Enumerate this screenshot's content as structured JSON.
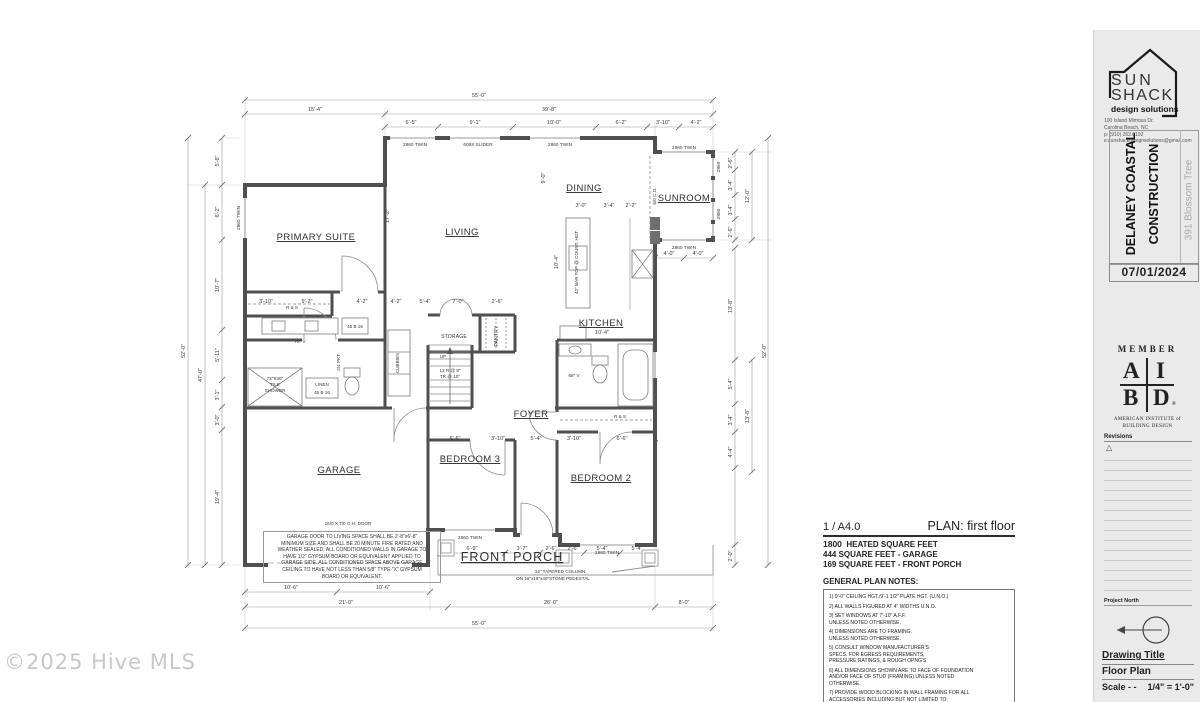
{
  "watermark": "©2025 Hive MLS",
  "rooms": {
    "primary": "PRIMARY SUITE",
    "living": "LIVING",
    "dining": "DINING",
    "sunroom": "SUNROOM",
    "kitchen": "KITCHEN",
    "foyer": "FOYER",
    "garage": "GARAGE",
    "bedroom3": "BEDROOM 3",
    "bedroom2": "BEDROOM 2",
    "porch": "FRONT PORCH",
    "storage": "STORAGE",
    "pantry": "PANTRY"
  },
  "windows": {
    "twin": "2860 TWIN",
    "slider": "6068 SLIDER",
    "single": "2860"
  },
  "fixtures": {
    "rs": "R & S",
    "b4516": "45 B 16",
    "linen": "LINEN",
    "cubbies": "CUBBIES",
    "vanity72": "72\" V",
    "vanity68": "68\" V",
    "shower1": "72\"X36\"",
    "shower2": "TILE",
    "shower3": "SHOWER",
    "pkt": "2/4 PKT.",
    "co": "6/0 C.O.",
    "bartop": "42\" BAR TOP @ COUNT. HGT.",
    "up": "UP",
    "stairs1": "13 R @ 8\"",
    "stairs2": "TR @ 10\""
  },
  "plan_notes": {
    "oh_door": "16/0 X 7/0 O.H. DOOR",
    "garage_note": "GARAGE DOOR TO LIVING SPACE SHALL BE 2'-8\"x6'-8\"\nMINIMUM SIZE AND SHALL BE 20 MINUTE FIRE RATED AND\nWEATHER SEALED. ALL CONDITIONED WALLS IN GARAGE TO\nHAVE 1/2\" GYPSUM BOARD OR EQUIVALENT APPLIED TO\nGARAGE SIDE. ALL CONDITIONED SPACE ABOVE GARAGE\nCEILING TO HAVE NOT LESS THAN 5/8\" TYPE \"X\" GYPSUM\nBOARD OR EQUIVALENT.",
    "column1": "14\" TAPERED COLUMN",
    "column2": "ON 16\"x16\"x40\"STONE PEDESTAL"
  },
  "dims": {
    "top1": [
      "55'-0\""
    ],
    "top2": [
      "15'-4\"",
      "39'-8\""
    ],
    "top3": [
      "6'-5\"",
      "9'-1\"",
      "10'-0\"",
      "6'-2\"",
      "3'-10\"",
      "4'-2\""
    ],
    "left": [
      "5'-6\"",
      "6'-2\"",
      "10'-7\"",
      "5'-11\"",
      "3'-1\"",
      "3'-0\"",
      "19'-4\"",
      "47'-0\"",
      "52'-0\""
    ],
    "right": [
      "2'-6\"",
      "3'-4\"",
      "3'-4\"",
      "2'-6\"",
      "12'-0\"",
      "13'-8\"",
      "5'-4\"",
      "3'-4\"",
      "4'-4\"",
      "2'-0\"",
      "13'-8\"",
      "52'-0\""
    ],
    "bottom": [
      "6'-9\"",
      "3'-7\"",
      "2'-6\"",
      "2'-6\"",
      "5'-4\"",
      "5'-4\"",
      "10'-6\"",
      "10'-6\"",
      "21'-0\"",
      "26'-0\"",
      "8'-0\"",
      "55'-0\""
    ],
    "interior": [
      "17'-2\"",
      "9'-0\"",
      "10'-4\"",
      "3'-0\"",
      "3'-4\"",
      "2'-2\"",
      "10'-4\"",
      "3'-10\"",
      "9'-2\"",
      "4'-2\"",
      "4'-2\"",
      "5'-4\"",
      "7'-0\"",
      "2'-6\"",
      "6'-6\"",
      "3'-10\"",
      "5'-4\"",
      "3'-10\"",
      "6'-6\"",
      "4'-0\"",
      "4'-0\""
    ]
  },
  "plan_info": {
    "sheet_ref": "1 / A4.0",
    "plan_label": "PLAN: first floor",
    "sqft_value": "1800",
    "sqft_label": "HEATED SQUARE FEET",
    "garage_sqft": "444 SQUARE FEET - GARAGE",
    "porch_sqft": "169 SQUARE FEET - FRONT PORCH",
    "notes_title": "GENERAL PLAN NOTES:",
    "notes": [
      "1) 9'-0\" CEILING HGT./9'-1 1/2\" PLATE HGT. (U.N.O.)",
      "2) ALL WALLS FIGURED AT 4\" WIDTHS U.N.O.",
      "3) SET WINDOWS AT 7'-10\" A.F.F.\n    UNLESS NOTED OTHERWISE.",
      "4) DIMENSIONS ARE TO FRAMING.\n    UNLESS NOTED OTHERWISE.",
      "5) CONSULT WINDOW MANUFACTURER'S\n    SPECS. FOR EGRESS REQUIREMENTS,\n    PRESSURE RATINGS, & ROUGH OPNG'S.",
      "6) ALL DIMENSIONS SHOWN ARE TO FACE OF FOUNDATION\nAND/OR FACE OF STUD (FRAMING) UNLESS NOTED\nOTHERWISE.",
      "7) PROVIDE WOOD BLOCKING IN WALL FRAMING FOR ALL\nACCESSORIES INCLUDING BUT NOT LIMITED TO:\nTOWEL BARS, TOILET PAPER HOLDERS, SHELVING\nATTACHMENT, ROBE HOOKS, GRAB BARS, ETC."
    ]
  },
  "title_block": {
    "logo_line1": "SUN",
    "logo_line2": "SHACK",
    "logo_line3": "design solutions",
    "address": [
      "100 Island Mimosa Dr.",
      "Carolina Beach, NC",
      "p: (910) 262.0192",
      "e:sunshackdesignsolutions@gmail.com"
    ],
    "client1": "DELANEY COASTAL",
    "client2": "CONSTRUCTION",
    "project": "391 Blossom Tree",
    "date": "07/01/2024",
    "member": "MEMBER",
    "aibd_a": "A",
    "aibd_i": "I",
    "aibd_b": "B",
    "aibd_d": "D",
    "aibd_reg": "®",
    "aibd_org1": "AMERICAN INSTITUTE of",
    "aibd_org2": "BUILDING DESIGN",
    "revisions": "Revisions",
    "revision_marker": "△",
    "project_north": "Project North",
    "drawing_title_label": "Drawing Title",
    "drawing_title": "Floor Plan",
    "scale_label": "Scale - -",
    "scale_value": "1/4\" = 1'-0\""
  }
}
